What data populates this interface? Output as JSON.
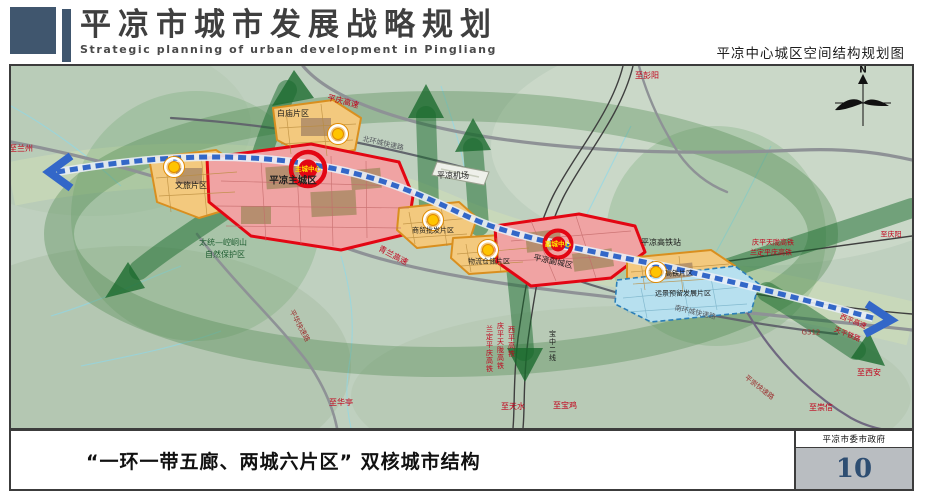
{
  "header": {
    "title_cn": "平凉市城市发展战略规划",
    "title_en": "Strategic planning of urban development in Pingliang",
    "map_title": "平凉中心城区空间结构规划图"
  },
  "footer": {
    "caption": "“一环一带五廊、两城六片区” 双核城市结构",
    "agency": "平凉市委市政府",
    "page_number": "10"
  },
  "map": {
    "compass": "N",
    "labels": [
      {
        "text": "至兰州"
      },
      {
        "text": "平庆高速"
      },
      {
        "text": "北环城快速路"
      },
      {
        "text": "白庙片区"
      },
      {
        "text": "平凉机场"
      },
      {
        "text": "至彭阳"
      },
      {
        "text": "庆平天陇高铁"
      },
      {
        "text": "兰定平庆高铁"
      },
      {
        "text": "至庆阳"
      },
      {
        "text": "平凉高铁站"
      },
      {
        "text": "高铁片区"
      },
      {
        "text": "远景预留发展片区"
      },
      {
        "text": "平凉主城区"
      },
      {
        "text": "主城中心"
      },
      {
        "text": "商贸批发片区"
      },
      {
        "text": "物流仓储片区"
      },
      {
        "text": "副城中心"
      },
      {
        "text": "平凉副城区"
      },
      {
        "text": "太统—崆峒山"
      },
      {
        "text": "自然保护区"
      },
      {
        "text": "青兰高速"
      },
      {
        "text": "文旅片区"
      },
      {
        "text": "南环城快速路"
      },
      {
        "text": "G312"
      },
      {
        "text": "西平高速"
      },
      {
        "text": "天平铁路"
      },
      {
        "text": "至西安"
      },
      {
        "text": "平崇快速路"
      },
      {
        "text": "至崇信"
      },
      {
        "text": "至华亭"
      },
      {
        "text": "宝中二线"
      },
      {
        "text": "西平高铁"
      },
      {
        "text": "庆平天陇高铁"
      },
      {
        "text": "兰定平庆高铁"
      },
      {
        "text": "至天水"
      },
      {
        "text": "至宝鸡"
      },
      {
        "text": "平华快速路"
      }
    ],
    "colors": {
      "core_red": "#e30613",
      "zone_orange": "#f3c97e",
      "zone_pink": "#f0a3a3",
      "reserve_blue": "#b7e0ef",
      "transit_blue": "#3367c8",
      "corridor_green": "#1b6e33",
      "header_blue": "#40566e",
      "page_number_blue": "#2e4e72"
    }
  }
}
